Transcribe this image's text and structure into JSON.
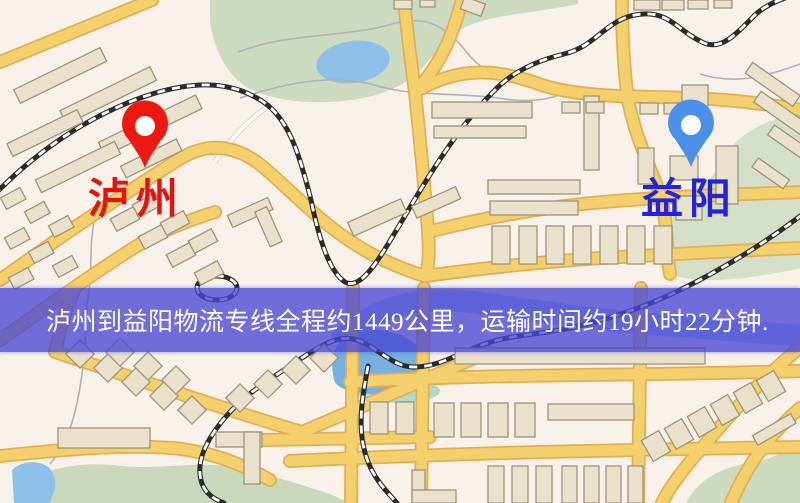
{
  "map": {
    "origin_label": "泸州",
    "destination_label": "益阳",
    "origin_label_color": "#e51212",
    "destination_label_color": "#2323dd",
    "origin_pin": "red-pin",
    "destination_pin": "blue-pin",
    "origin_pin_color": "#ed1810",
    "destination_pin_color": "#4a90e8"
  },
  "banner": {
    "text": "泸州到益阳物流专线全程约1449公里，运输时间约19小时22分钟.",
    "background_color": "#4946d4",
    "text_color": "#ffffff"
  },
  "palette": {
    "map_background": "#f8f1ea",
    "road_fill": "#f4d06c",
    "road_border": "#e2ae55",
    "building_fill": "#e9e1cb",
    "building_outline": "#9d9379",
    "park_green": "#ccdbc0",
    "water_blue": "#8cc0e8",
    "railway_black": "#2b2b2b"
  }
}
